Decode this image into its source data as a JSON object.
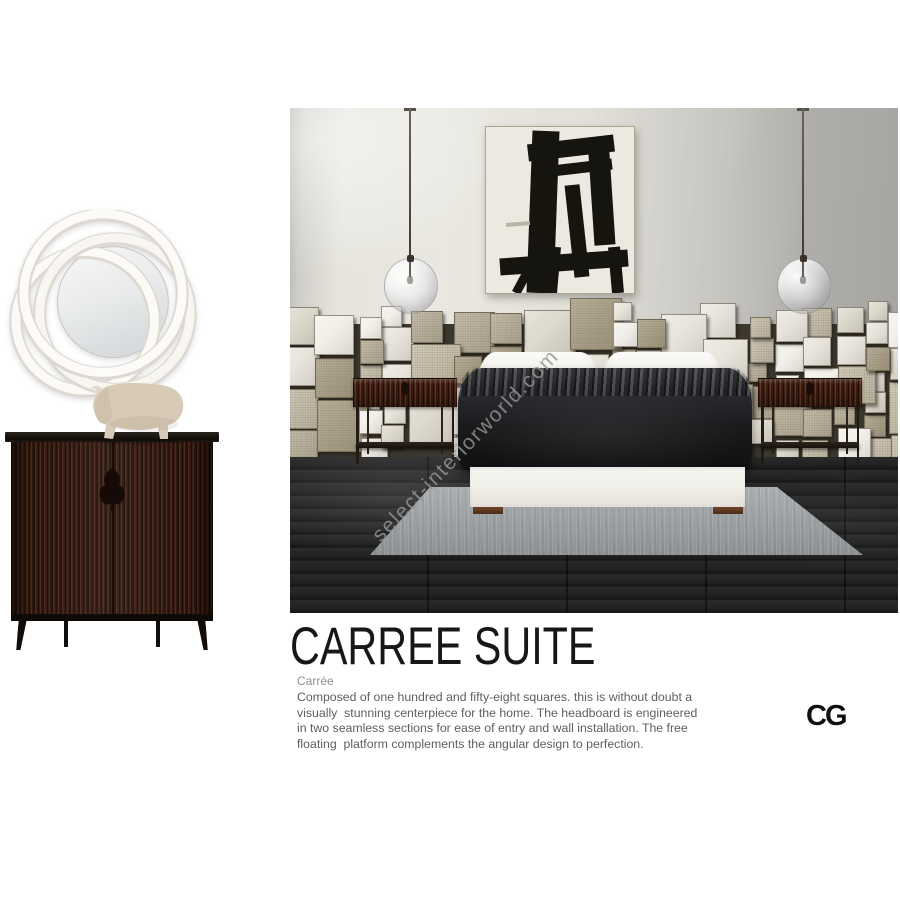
{
  "branding": {
    "watermark": "select-interiorworld.com",
    "logo_text": "CG"
  },
  "product": {
    "title": "CARREE SUITE",
    "subtitle": "Carrée",
    "description_lines": [
      "Composed of one hundred and fifty-eight squares. this is without doubt a",
      "visually  stunning centerpiece for the home. The headboard is engineered",
      "in two seamless sections for ease of entry and wall installation. The free",
      "floating  platform complements the angular design to perfection."
    ]
  },
  "palette": {
    "wall_light": "#e9e7e0",
    "wall_dark": "#a7a6a2",
    "floor_dark": "#1d1d1e",
    "rug_gray": "#9aa0a2",
    "duvet_charcoal": "#1b1c1e",
    "bed_base_white": "#f1efe9",
    "wood_foot_brown": "#5f3a24",
    "nightstand_wood": "#4a2418",
    "cabinet_wood": "#32190f",
    "mirror_white": "#faf8f4",
    "sculpture_beige": "#d7cab7",
    "watermark_gray": "#969696"
  },
  "scene": {
    "headboard_palette": [
      "#f1efe8",
      "#e7e3da",
      "#dcd7cb",
      "#cdc5b2",
      "#bdb4a0",
      "#aca289"
    ]
  }
}
